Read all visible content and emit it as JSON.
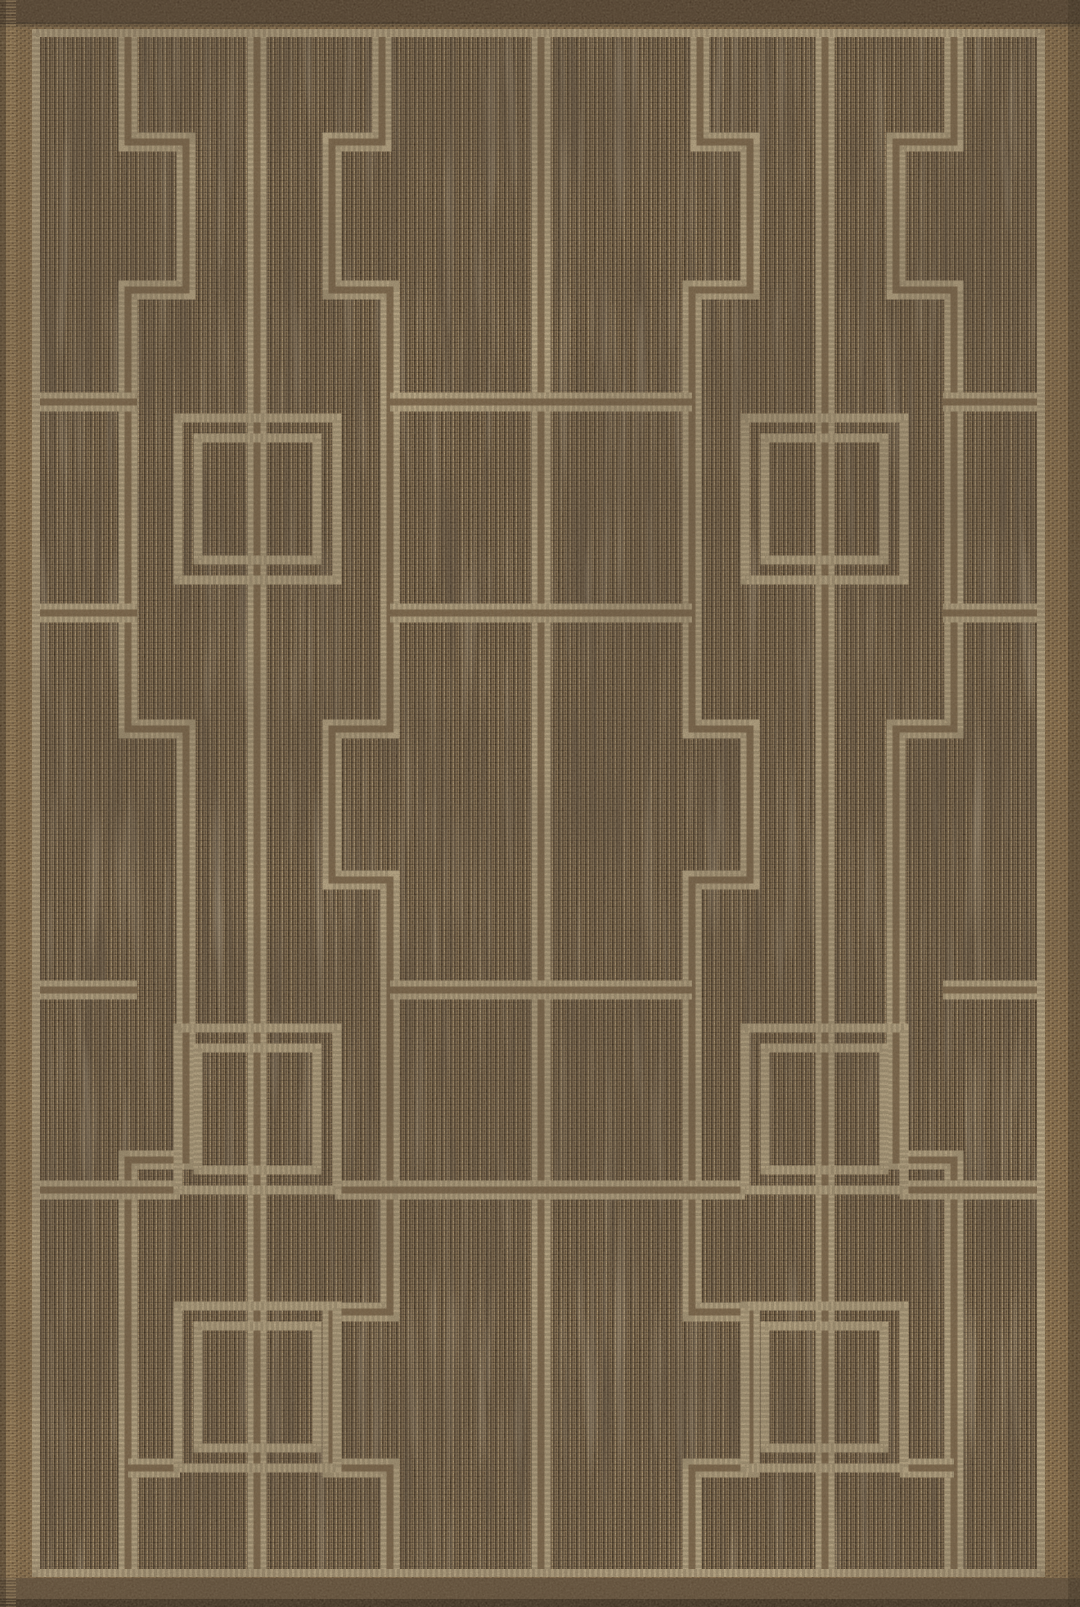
{
  "image": {
    "kind": "product-photo",
    "subject": "flat-woven indoor/outdoor area rug",
    "description": "Brown and natural tan flatweave rug with a geometric Greek-key trellis pattern: full-height pillar lines, stepped fret meanders, ladder rungs across the center column, and concentric double-outline squares; framed by a thin cream border line inside a warm brown woven edge with dark bindings and a frayed left fringe.",
    "width_px": 1080,
    "height_px": 1607
  },
  "palette": {
    "field_base": "#6b563d",
    "field_dark_a": "#382a1a",
    "field_dark_b": "#4a3926",
    "field_mid_a": "#7b654a",
    "field_mid_b": "#8a7252",
    "field_mid_c": "#5f4b34",
    "field_light_a": "#a78e66",
    "field_light_b": "#967e5a",
    "fleck_light": "#d9c9a6",
    "line_light": "#cfbe99",
    "line_core": "#70593d",
    "stitch_dark": "#1b1106",
    "border_base": "#8a6d47",
    "border_dark_a": "#55412b",
    "border_dark_b": "#4f3c27",
    "border_dark_c": "#5d4830",
    "border_light_a": "#b79a6b",
    "border_light_b": "#ab8f60",
    "binding_top": "#453424",
    "selvage": "#5d4a35",
    "edge_dark": "#2e2215",
    "fringe": "#c2a677"
  },
  "geometry": {
    "border_line": {
      "x": 36,
      "y": 33,
      "w": 1005,
      "h": 1540,
      "stroke_w": 8
    },
    "line_stroke_w": 19,
    "core_stroke_w": 7,
    "square_stroke_w": 9,
    "verticals": [
      {
        "x": 257,
        "y1": 33,
        "y2": 1573
      },
      {
        "x": 541,
        "y1": 33,
        "y2": 1573
      },
      {
        "x": 825,
        "y1": 33,
        "y2": 1573
      }
    ],
    "meanders": [
      {
        "name": "outer-left",
        "path": "M 128 33 V 142 H 186 V 290 H 128 V 729 H 186 V 1160 H 128 V 1573"
      },
      {
        "name": "outer-right",
        "path": "M 954 33 V 142 H 896 V 290 H 954 V 729 H 896 V 1160 H 954 V 1573"
      },
      {
        "name": "inner-left",
        "path": "M 382 33 V 142 H 332 V 290 H 390 V 729 H 332 V 880 H 390 V 1312 H 332 V 1468 H 390 V 1573"
      },
      {
        "name": "inner-right",
        "path": "M 700 33 V 142 H 750 V 290 H 692 V 729 H 750 V 880 H 692 V 1312 H 750 V 1468 H 692 V 1573"
      }
    ],
    "rungs": {
      "levels": [
        402,
        613,
        990,
        1190
      ],
      "x1": 390,
      "x2": 692
    },
    "stubs": [
      {
        "y": 402,
        "x1": 36,
        "x2": 137
      },
      {
        "y": 402,
        "x1": 943,
        "x2": 1044
      },
      {
        "y": 613,
        "x1": 36,
        "x2": 137
      },
      {
        "y": 613,
        "x1": 943,
        "x2": 1044
      },
      {
        "y": 990,
        "x1": 36,
        "x2": 137
      },
      {
        "y": 990,
        "x1": 943,
        "x2": 1044
      },
      {
        "y": 1190,
        "x1": 36,
        "x2": 180
      },
      {
        "y": 1190,
        "x1": 900,
        "x2": 1044
      },
      {
        "y": 1190,
        "x1": 335,
        "x2": 395
      },
      {
        "y": 1190,
        "x1": 687,
        "x2": 745
      },
      {
        "y": 1468,
        "x1": 128,
        "x2": 180
      },
      {
        "y": 1468,
        "x1": 900,
        "x2": 954
      }
    ],
    "squares": {
      "row_y": [
        418,
        1028,
        1306
      ],
      "col_x": [
        178,
        745
      ],
      "outer_w": 159,
      "outer_h": 162,
      "inner_inset": 20
    }
  }
}
